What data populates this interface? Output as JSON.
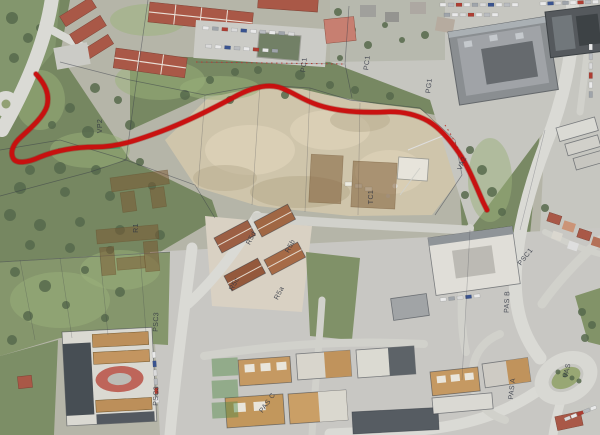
{
  "map": {
    "route": {
      "color": "#c80000",
      "width": 4.5,
      "path": "M36,74 C45,84 50,94 47,106 C44,116 32,127 21,137 C13,144 10,152 13,158 C16,164 27,163 40,157 C55,151 72,147 95,147 C118,147 138,140 162,131 C186,122 214,108 238,95 C252,88 266,84 278,87 C290,90 300,99 318,105 C336,111 360,113 384,112 C400,111 415,114 428,121 C440,128 450,140 459,153 C468,166 476,186 483,202 C485,206 486,208 487,210",
      "aux_green": [
        "M58,149 L120,148",
        "M452,141 C462,155 472,176 480,195"
      ]
    },
    "labels": [
      {
        "t": "VP2",
        "x": 102,
        "y": 126,
        "r": -90
      },
      {
        "t": "PC1",
        "x": 306,
        "y": 65,
        "r": -83
      },
      {
        "t": "PC1",
        "x": 369,
        "y": 63,
        "r": -83
      },
      {
        "t": "PG1",
        "x": 431,
        "y": 86,
        "r": -83
      },
      {
        "t": "TC1",
        "x": 373,
        "y": 197,
        "r": -90
      },
      {
        "t": "VA2",
        "x": 464,
        "y": 164,
        "r": -68
      },
      {
        "t": "PSC1",
        "x": 527,
        "y": 258,
        "r": -52
      },
      {
        "t": "PAS B",
        "x": 509,
        "y": 302,
        "r": -88
      },
      {
        "t": "PAS A",
        "x": 514,
        "y": 389,
        "r": -84
      },
      {
        "t": "VAS",
        "x": 569,
        "y": 371,
        "r": -78
      },
      {
        "t": "R1",
        "x": 138,
        "y": 228,
        "r": -90
      },
      {
        "t": "PSC3",
        "x": 158,
        "y": 322,
        "r": -88
      },
      {
        "t": "PSC3",
        "x": 158,
        "y": 396,
        "r": -88
      },
      {
        "t": "PAS C",
        "x": 269,
        "y": 404,
        "r": -55
      },
      {
        "t": "R5d",
        "x": 253,
        "y": 239,
        "r": -62
      },
      {
        "t": "R5b",
        "x": 292,
        "y": 247,
        "r": -62
      },
      {
        "t": "R5c",
        "x": 236,
        "y": 285,
        "r": -62
      },
      {
        "t": "R5a",
        "x": 281,
        "y": 294,
        "r": -62
      }
    ],
    "palette": {
      "route_red": "#c80000",
      "overlay_sepia": "rgba(115,78,38,0.5)",
      "label_ink": "#232836"
    }
  }
}
